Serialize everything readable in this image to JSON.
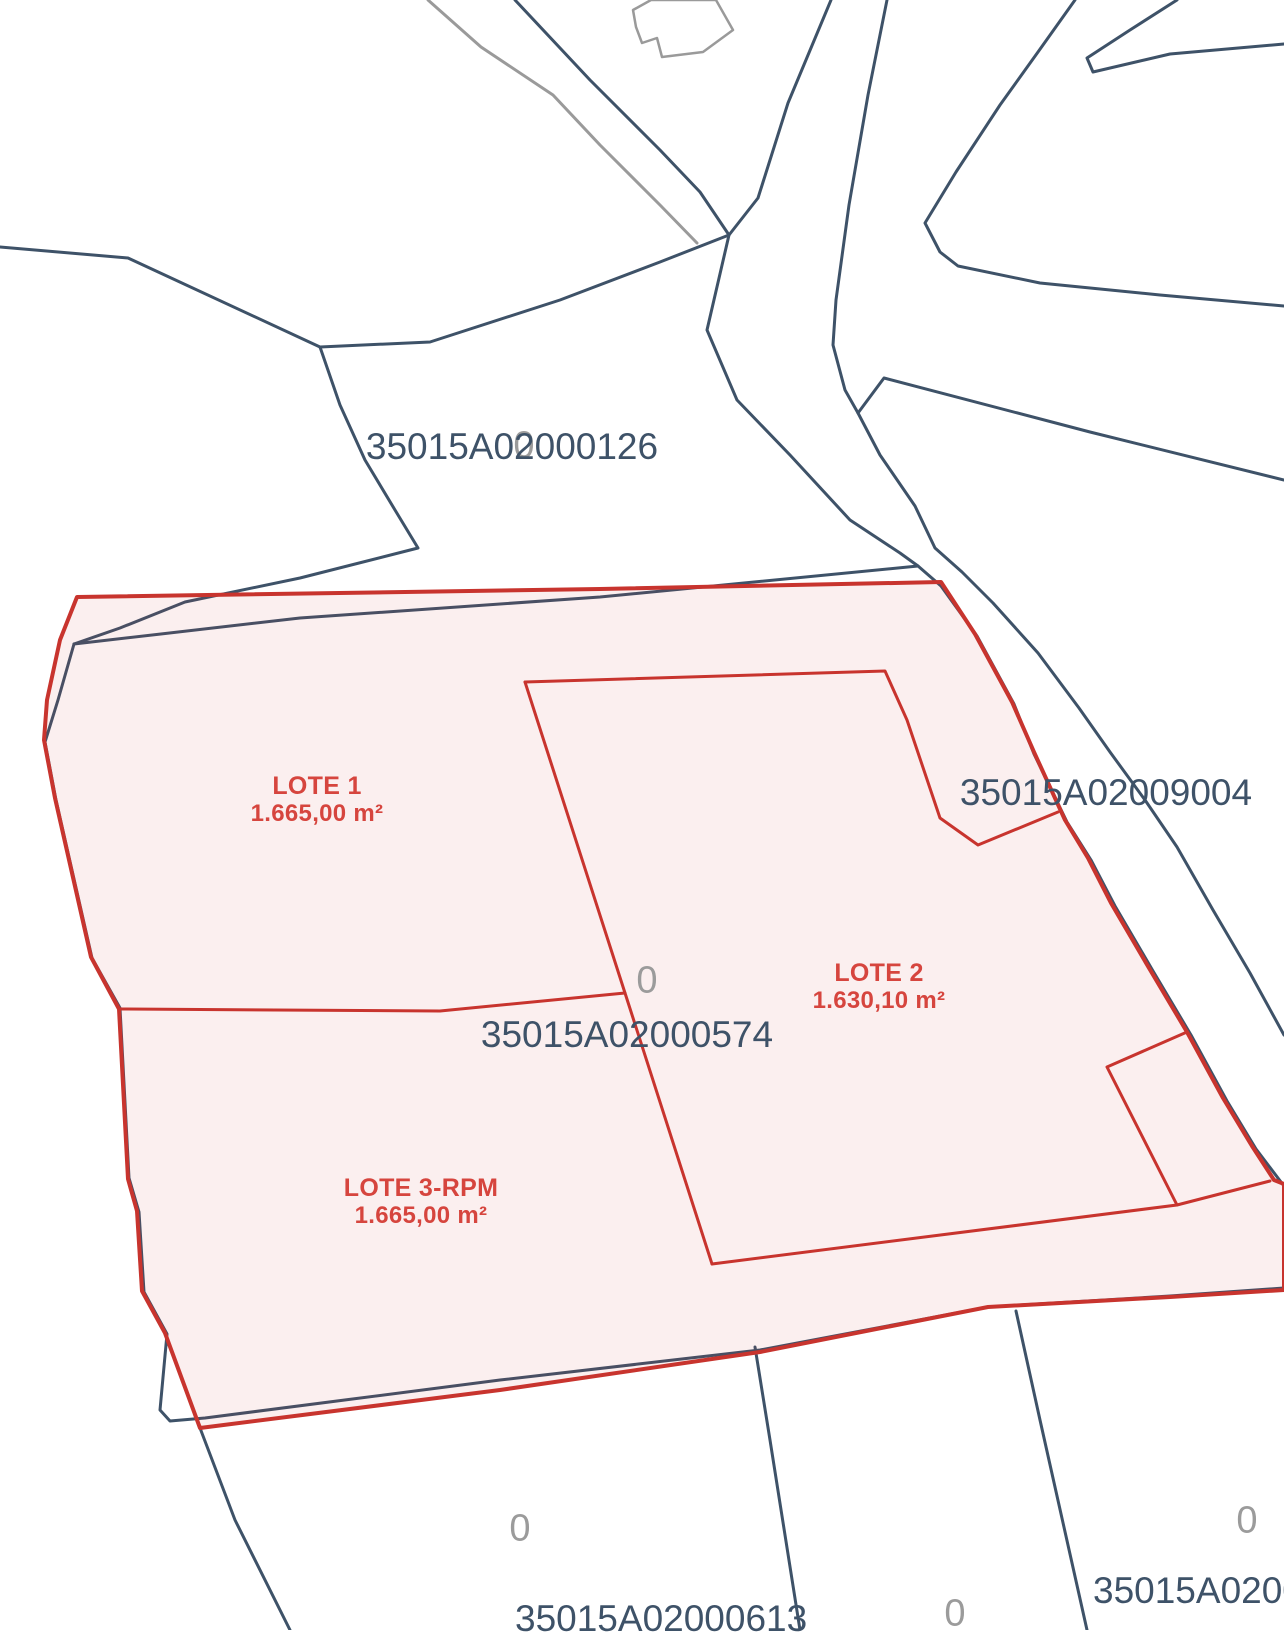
{
  "map": {
    "parcel_labels": {
      "p126": "35015A02000126",
      "p9004": "35015A02009004",
      "p574": "35015A02000574",
      "p613": "35015A02000613",
      "p_partial_right": "35015A0200"
    },
    "lots": [
      {
        "name": "LOTE 1",
        "area": "1.665,00 m²"
      },
      {
        "name": "LOTE 2",
        "area": "1.630,10 m²"
      },
      {
        "name": "LOTE 3-RPM",
        "area": "1.665,00 m²"
      }
    ],
    "zero_markers": [
      "0",
      "0",
      "0",
      "0",
      "0"
    ],
    "colors": {
      "boundary_dark": "#3e5268",
      "boundary_gray": "#9a9a9a",
      "overlay_red": "#c8342e",
      "label_dark": "#3e5268",
      "label_red": "#d6453e",
      "label_gray": "#9b9b9b",
      "background": "#ffffff"
    }
  }
}
